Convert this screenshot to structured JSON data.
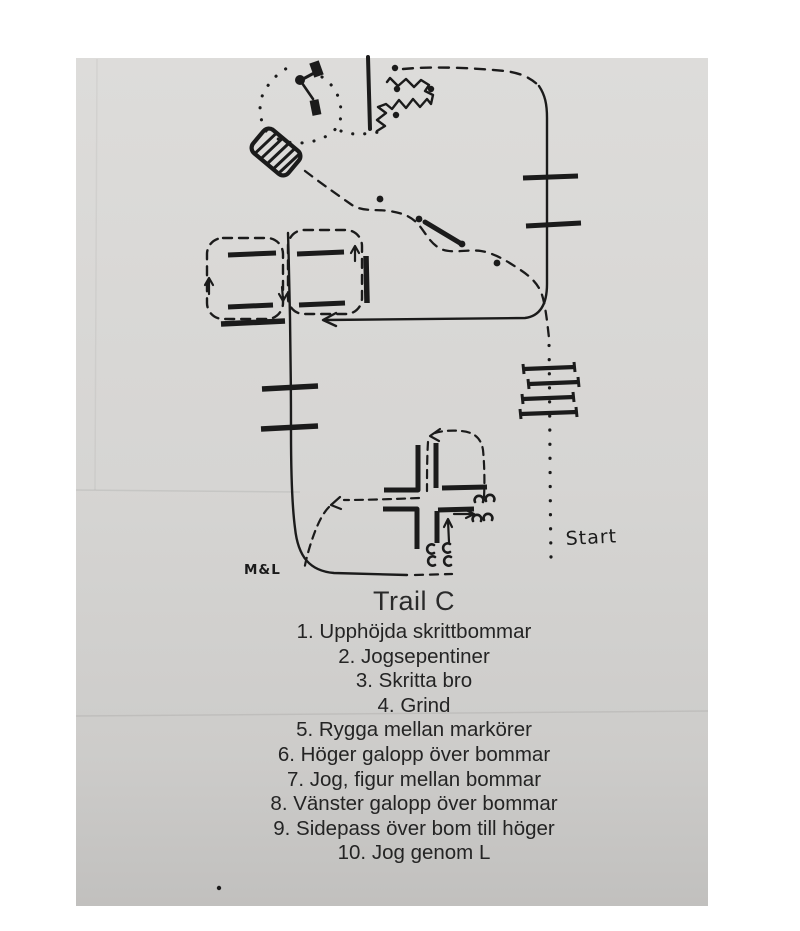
{
  "colors": {
    "ink": "#1b1b1b",
    "paper_gray": "#d6d5d3",
    "page_background": "#ffffff",
    "caption_text": "#262626"
  },
  "diagram": {
    "start_label": "Start",
    "initials_label": "M&L",
    "symbols": [
      "start-dotted-walk-path",
      "raised-walk-poles",
      "jog-serpentine-path",
      "serpentine-marker-dots",
      "walk-bridge",
      "gate",
      "walk-loop-dotted",
      "backup-zigzag",
      "right-lope-line",
      "lope-poles-right",
      "figure-eight-boxes",
      "left-lope-line",
      "lope-poles-left",
      "sidepass-cross-poles",
      "hoofprint-marks",
      "l-jog-path"
    ]
  },
  "trail": {
    "title": "Trail C",
    "obstacles": [
      "1. Upphöjda skrittbommar",
      "2. Jogsepentiner",
      "3. Skritta bro",
      "4. Grind",
      "5. Rygga mellan markörer",
      "6. Höger galopp över bommar",
      "7. Jog, figur mellan bommar",
      "8. Vänster galopp över bommar",
      "9. Sidepass över bom till höger",
      "10. Jog genom L"
    ]
  }
}
